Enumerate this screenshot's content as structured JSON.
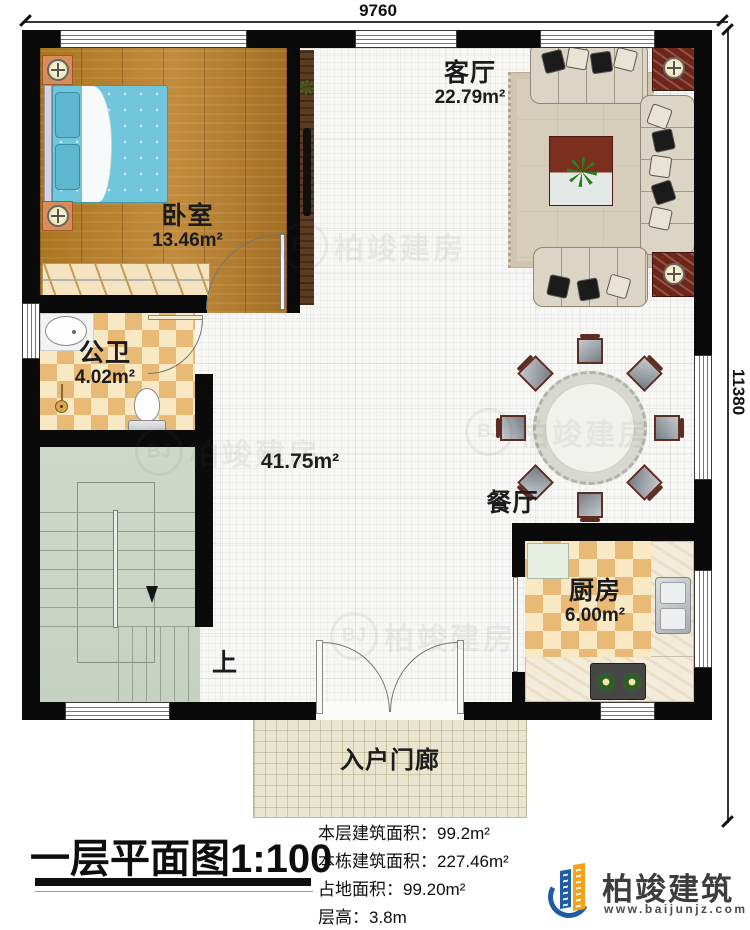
{
  "dimensions": {
    "top": "9760",
    "right": "11380"
  },
  "rooms": {
    "bedroom": {
      "name": "卧室",
      "area": "13.46m²"
    },
    "living": {
      "name": "客厅",
      "area": "22.79m²"
    },
    "bathroom": {
      "name": "公卫",
      "area": "4.02m²"
    },
    "hall": {
      "area": "41.75m²"
    },
    "dining": {
      "name": "餐厅"
    },
    "kitchen": {
      "name": "厨房",
      "area": "6.00m²"
    },
    "porch": {
      "name": "入户门廊"
    },
    "stairs": {
      "up_label": "上"
    }
  },
  "title": {
    "text": "一层平面图",
    "scale": "1:100"
  },
  "stats": {
    "lines": [
      "本层建筑面积：99.2m²",
      "本栋建筑面积：227.46m²",
      "占地面积：99.20m²",
      "层高：3.8m"
    ]
  },
  "logo": {
    "company": "柏竣建筑",
    "website": "www.baijunjz.com"
  },
  "watermark": {
    "badge": "BJ",
    "text": "柏竣建房"
  },
  "colors": {
    "wall": "#0a0a0a",
    "logo_blue": "#1e5ca6",
    "logo_orange": "#f5a318",
    "stairs_floor": "#cbd5c6",
    "checker_tan": "#e8ba76"
  }
}
